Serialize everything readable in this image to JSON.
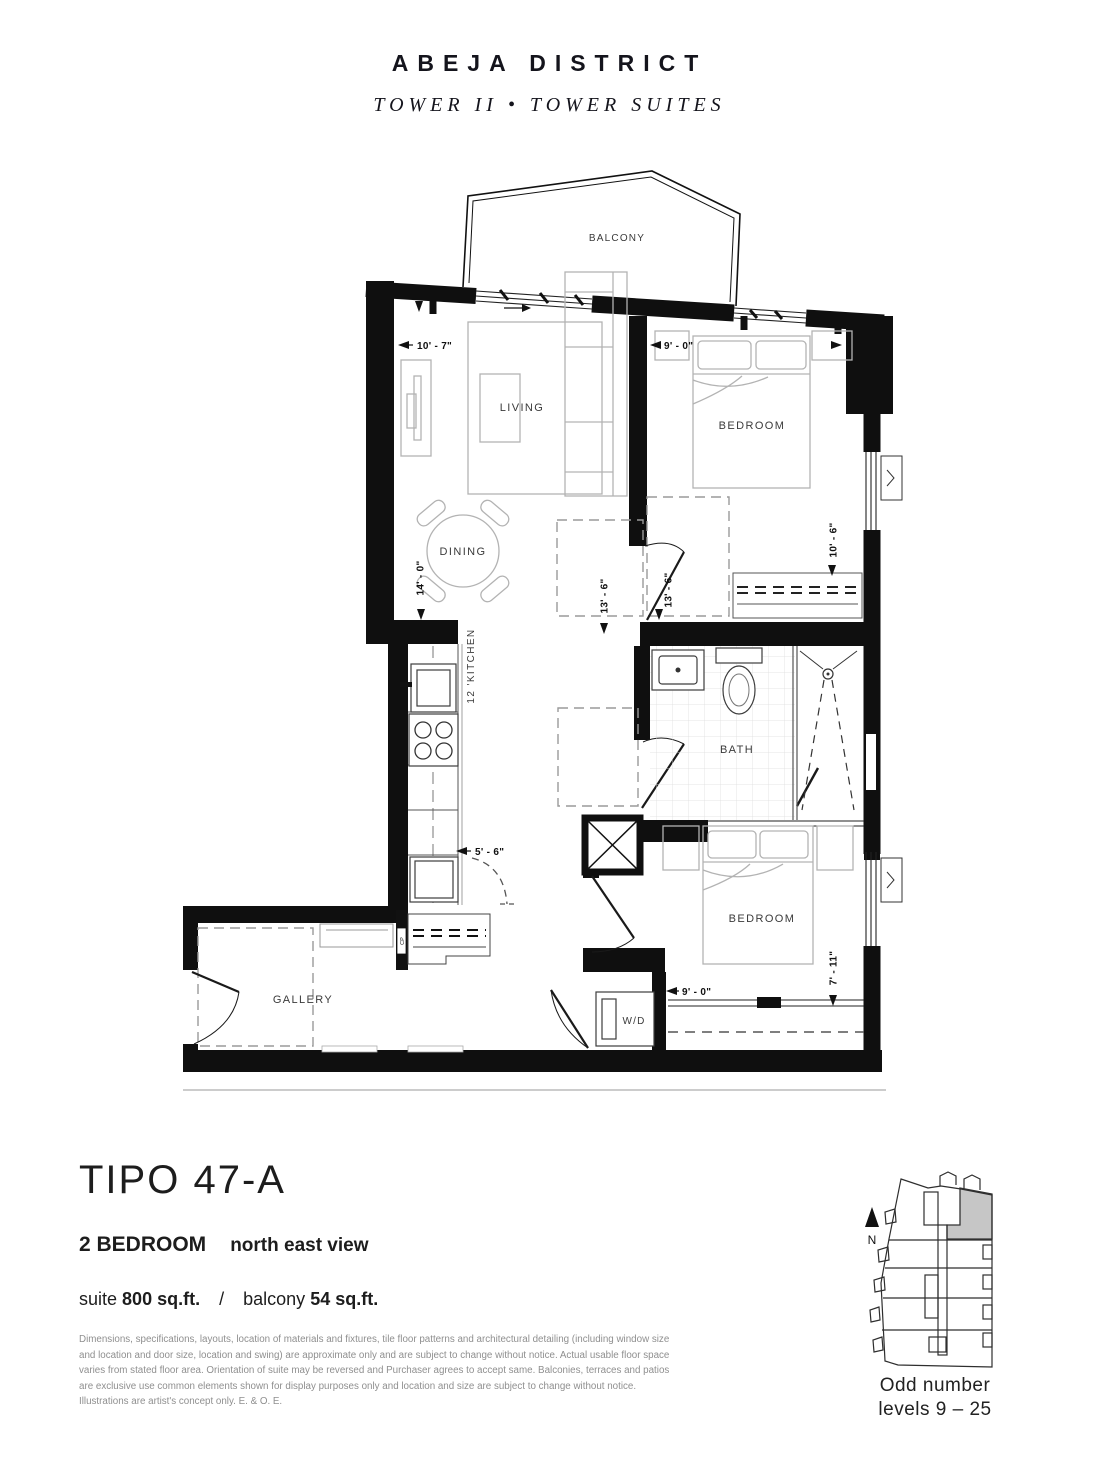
{
  "header": {
    "brand": "ABEJA DISTRICT",
    "subtitle": "TOWER II  •  TOWER SUITES"
  },
  "plan": {
    "labels": {
      "balcony": "BALCONY",
      "living": "LIVING",
      "dining": "DINING",
      "kitchen": "12 'KITCHEN",
      "bath": "BATH",
      "bedroom_top": "BEDROOM",
      "bedroom_bottom": "BEDROOM",
      "gallery": "GALLERY",
      "washer_dryer": "W/D",
      "closet": "CP"
    },
    "dimensions": {
      "living_width": "10' - 7\"",
      "bedroom_top_width": "9' - 0\"",
      "living_depth": "14' - 0\"",
      "hall_left": "13' - 6\"",
      "hall_right": "13' - 6\"",
      "bedroom_top_depth": "10' - 6\"",
      "kitchen_width": "5' - 6\"",
      "bedroom_bottom_width": "9' - 0\"",
      "bedroom_bottom_depth": "7' - 11\""
    }
  },
  "details": {
    "plan_name": "TIPO 47-A",
    "bedrooms": "2 BEDROOM",
    "view": "north east view",
    "suite_label": "suite",
    "suite_area": "800 sq.ft.",
    "divider": "/",
    "balcony_label": "balcony",
    "balcony_area": "54 sq.ft.",
    "disclaimer": "Dimensions, specifications, layouts, location of materials and fixtures, tile floor patterns and architectural detailing (including window size and location and door size, location and swing) are approximate only and are subject to change without notice. Actual usable floor space varies from stated floor area. Orientation of suite may be reversed and Purchaser agrees to accept same. Balconies, terraces and patios are exclusive use common elements shown for display purposes only and location and size are subject to change without notice. Illustrations are artist's concept only. E. & O. E."
  },
  "keyplan": {
    "north": "N",
    "caption_line1": "Odd number",
    "caption_line2": "levels 9 – 25",
    "highlight_color": "#c6c6c6"
  }
}
